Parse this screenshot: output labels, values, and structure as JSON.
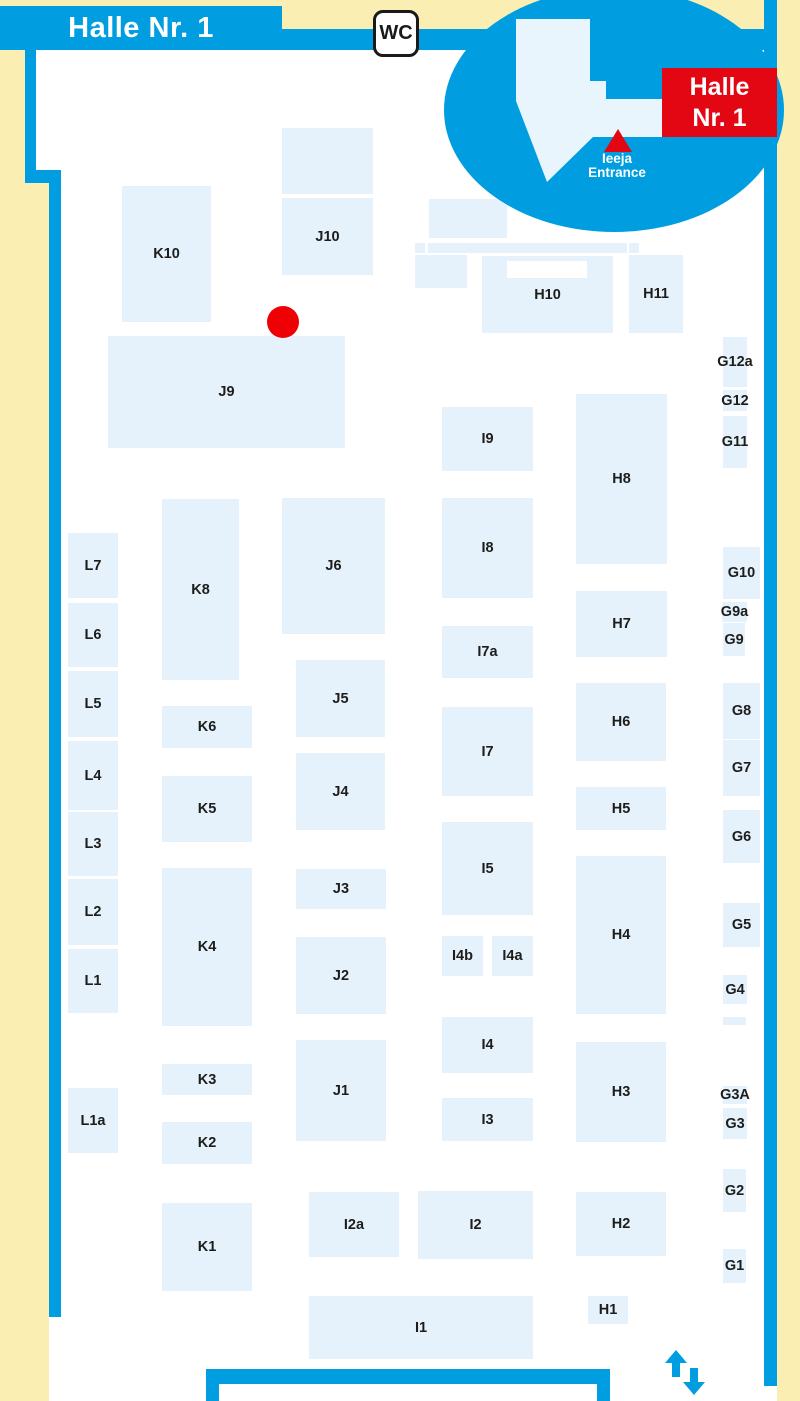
{
  "title": "Halle Nr. 1 hall plan",
  "colors": {
    "background_cream": "#FBEEB2",
    "hall_white": "#FFFFFF",
    "outline_blue": "#009EE0",
    "booth_fill": "#E6F2FB",
    "booth_label": "#1D1D1B",
    "marker_red": "#EE0004",
    "badge_red": "#E30613",
    "inset_hall_fill": "#E9F5FC"
  },
  "banner": {
    "title": "Halle Nr. 1"
  },
  "wc_sign": {
    "label": "WC"
  },
  "inset": {
    "badge_line1": "Halle",
    "badge_line2": "Nr. 1",
    "entrance_line1": "Ieeja",
    "entrance_line2": "Entrance"
  },
  "marker": {
    "kind": "red-dot",
    "x": 283,
    "y": 322,
    "radius": 16
  },
  "booths": [
    {
      "label": "K10",
      "x": 122,
      "y": 186,
      "w": 89,
      "h": 136
    },
    {
      "label": "J10",
      "x": 282,
      "y": 198,
      "w": 91,
      "h": 77
    },
    {
      "label": "J9",
      "x": 108,
      "y": 336,
      "w": 237,
      "h": 112
    },
    {
      "label": "H10",
      "x": 482,
      "y": 256,
      "w": 131,
      "h": 77,
      "notch": {
        "x": 25,
        "y": 5,
        "w": 80,
        "h": 17
      }
    },
    {
      "label": "H11",
      "x": 629,
      "y": 255,
      "w": 54,
      "h": 78
    },
    {
      "label": "G12a",
      "x": 723,
      "y": 337,
      "w": 24,
      "h": 50
    },
    {
      "label": "G12",
      "x": 723,
      "y": 390,
      "w": 24,
      "h": 21
    },
    {
      "label": "G11",
      "x": 723,
      "y": 416,
      "w": 24,
      "h": 52
    },
    {
      "label": "I9",
      "x": 442,
      "y": 407,
      "w": 91,
      "h": 64
    },
    {
      "label": "H8",
      "x": 576,
      "y": 394,
      "w": 91,
      "h": 170
    },
    {
      "label": "J6",
      "x": 282,
      "y": 498,
      "w": 103,
      "h": 136
    },
    {
      "label": "K8",
      "x": 162,
      "y": 499,
      "w": 77,
      "h": 181
    },
    {
      "label": "L7",
      "x": 68,
      "y": 533,
      "w": 50,
      "h": 65
    },
    {
      "label": "I8",
      "x": 442,
      "y": 498,
      "w": 91,
      "h": 100
    },
    {
      "label": "G10",
      "x": 723,
      "y": 547,
      "w": 37,
      "h": 52
    },
    {
      "label": "L6",
      "x": 68,
      "y": 603,
      "w": 50,
      "h": 64
    },
    {
      "label": "G9a",
      "x": 722,
      "y": 602,
      "w": 25,
      "h": 20
    },
    {
      "label": "G9",
      "x": 723,
      "y": 623,
      "w": 22,
      "h": 33
    },
    {
      "label": "I7a",
      "x": 442,
      "y": 626,
      "w": 91,
      "h": 52
    },
    {
      "label": "J5",
      "x": 296,
      "y": 660,
      "w": 89,
      "h": 77
    },
    {
      "label": "H7",
      "x": 576,
      "y": 591,
      "w": 91,
      "h": 66
    },
    {
      "label": "L5",
      "x": 68,
      "y": 671,
      "w": 50,
      "h": 66
    },
    {
      "label": "G8",
      "x": 723,
      "y": 683,
      "w": 37,
      "h": 56
    },
    {
      "label": "K6",
      "x": 162,
      "y": 706,
      "w": 90,
      "h": 42
    },
    {
      "label": "I7",
      "x": 442,
      "y": 707,
      "w": 91,
      "h": 89
    },
    {
      "label": "H6",
      "x": 576,
      "y": 683,
      "w": 90,
      "h": 78
    },
    {
      "label": "L4",
      "x": 68,
      "y": 741,
      "w": 50,
      "h": 69
    },
    {
      "label": "G7",
      "x": 723,
      "y": 740,
      "w": 37,
      "h": 56
    },
    {
      "label": "J4",
      "x": 296,
      "y": 753,
      "w": 89,
      "h": 77
    },
    {
      "label": "K5",
      "x": 162,
      "y": 776,
      "w": 90,
      "h": 66
    },
    {
      "label": "H5",
      "x": 576,
      "y": 787,
      "w": 90,
      "h": 43
    },
    {
      "label": "G6",
      "x": 723,
      "y": 810,
      "w": 37,
      "h": 53
    },
    {
      "label": "L3",
      "x": 68,
      "y": 812,
      "w": 50,
      "h": 64
    },
    {
      "label": "I5",
      "x": 442,
      "y": 822,
      "w": 91,
      "h": 93
    },
    {
      "label": "H4",
      "x": 576,
      "y": 856,
      "w": 90,
      "h": 158
    },
    {
      "label": "J3",
      "x": 296,
      "y": 869,
      "w": 90,
      "h": 40
    },
    {
      "label": "K4",
      "x": 162,
      "y": 868,
      "w": 90,
      "h": 158
    },
    {
      "label": "L2",
      "x": 68,
      "y": 879,
      "w": 50,
      "h": 66
    },
    {
      "label": "G5",
      "x": 723,
      "y": 903,
      "w": 37,
      "h": 44
    },
    {
      "label": "I4b",
      "x": 442,
      "y": 936,
      "w": 41,
      "h": 40
    },
    {
      "label": "I4a",
      "x": 492,
      "y": 936,
      "w": 41,
      "h": 40
    },
    {
      "label": "J2",
      "x": 296,
      "y": 937,
      "w": 90,
      "h": 77
    },
    {
      "label": "L1",
      "x": 68,
      "y": 949,
      "w": 50,
      "h": 64
    },
    {
      "label": "G4",
      "x": 723,
      "y": 975,
      "w": 24,
      "h": 29
    },
    {
      "label": "I4",
      "x": 442,
      "y": 1017,
      "w": 91,
      "h": 56
    },
    {
      "label": "J1",
      "x": 296,
      "y": 1040,
      "w": 90,
      "h": 101
    },
    {
      "label": "H3",
      "x": 576,
      "y": 1042,
      "w": 90,
      "h": 100
    },
    {
      "label": "K3",
      "x": 162,
      "y": 1064,
      "w": 90,
      "h": 31
    },
    {
      "label": "G3A",
      "x": 723,
      "y": 1086,
      "w": 24,
      "h": 18
    },
    {
      "label": "L1a",
      "x": 68,
      "y": 1088,
      "w": 50,
      "h": 65
    },
    {
      "label": "I3",
      "x": 442,
      "y": 1098,
      "w": 91,
      "h": 43
    },
    {
      "label": "G3",
      "x": 723,
      "y": 1108,
      "w": 24,
      "h": 31
    },
    {
      "label": "K2",
      "x": 162,
      "y": 1122,
      "w": 90,
      "h": 42
    },
    {
      "label": "G2",
      "x": 723,
      "y": 1169,
      "w": 23,
      "h": 43
    },
    {
      "label": "I2a",
      "x": 309,
      "y": 1192,
      "w": 90,
      "h": 65
    },
    {
      "label": "I2",
      "x": 418,
      "y": 1191,
      "w": 115,
      "h": 68
    },
    {
      "label": "H2",
      "x": 576,
      "y": 1192,
      "w": 90,
      "h": 64
    },
    {
      "label": "K1",
      "x": 162,
      "y": 1203,
      "w": 90,
      "h": 88
    },
    {
      "label": "G1",
      "x": 723,
      "y": 1249,
      "w": 23,
      "h": 34
    },
    {
      "label": "I1",
      "x": 309,
      "y": 1296,
      "w": 224,
      "h": 63
    },
    {
      "label": "H1",
      "x": 588,
      "y": 1296,
      "w": 40,
      "h": 28
    }
  ],
  "decor_rects": [
    {
      "x": 282,
      "y": 128,
      "w": 91,
      "h": 66
    },
    {
      "x": 429,
      "y": 199,
      "w": 78,
      "h": 39
    },
    {
      "x": 415,
      "y": 243,
      "w": 10,
      "h": 10
    },
    {
      "x": 428,
      "y": 243,
      "w": 199,
      "h": 10
    },
    {
      "x": 629,
      "y": 243,
      "w": 10,
      "h": 10
    },
    {
      "x": 415,
      "y": 255,
      "w": 52,
      "h": 33
    },
    {
      "x": 723,
      "y": 1017,
      "w": 23,
      "h": 8
    }
  ]
}
